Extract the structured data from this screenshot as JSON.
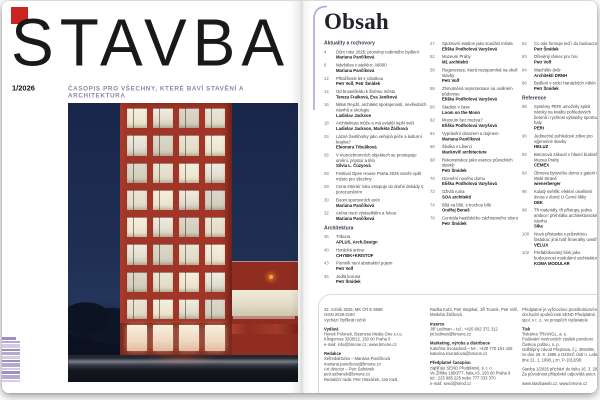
{
  "cover": {
    "masthead": "STAVBA",
    "issue": "1/2026",
    "tagline": "ČASOPIS PRO VŠECHNY, KTERÉ BAVÍ STAVĚNÍ A ARCHITEKTURA",
    "logo_color": "#c9241d",
    "photo_subject": "red high-rise office building at dusk with grid of lit windows, low red annex and road in foreground"
  },
  "contents": {
    "title": "Obsah",
    "columns": [
      {
        "items": [
          {
            "header": "Aktuality a rozhovory"
          },
          {
            "page": "4",
            "title": "Dům roku 2025: proměny rodinného bydlení",
            "author": "Mariana Pančíková"
          },
          {
            "page": "6",
            "title": "Návštěva v ateliéru: A8000",
            "author": "Mariana Pančíková"
          },
          {
            "page": "12",
            "title": "Přitažlivost let s robotkou",
            "author": "Petr Volf, Petr Šmídek"
          },
          {
            "page": "14",
            "title": "Od brownfieldu k živému městu",
            "author": "Tereza Fraiková, Eva Jeníková"
          },
          {
            "page": "16",
            "title": "Milan Rejchl, architekt spokojenosti, nevšedních návrhů a ekologie",
            "author": "Ladislav Jackson"
          },
          {
            "page": "18",
            "title": "Architektura může a má uvádět lepší svět",
            "author": "Ladislav Jackson, Markéta Žáčková"
          },
          {
            "page": "24",
            "title": "Lázně Šestihorky jako veřejná péče a kulturní krajina?",
            "author": "Eleonora Trbušková"
          },
          {
            "page": "26",
            "title": "V monochromních objektech se prostupuje umění, prostor a tělo",
            "author": "Silvia L. Čúzyová"
          },
          {
            "page": "28",
            "title": "Festival Open House Praha 2026 otevře opět město pro všechny",
            "author": ""
          },
          {
            "page": "29",
            "title": "Cena Interiér roku vstupuje do druhé dekády s porozuměním",
            "author": ""
          },
          {
            "page": "30",
            "title": "Boom sportovních arén",
            "author": "Mariana Pančíková"
          },
          {
            "page": "32",
            "title": "Aréna mezi výstavištěm a řekou",
            "author": "Mariana Pančíková"
          },
          {
            "header": "Architektura"
          },
          {
            "page": "36",
            "title": "Tribuna",
            "author": "APLUS, Arch.Design"
          },
          {
            "page": "40",
            "title": "Horácká aréna",
            "author": "CHYBIK+KRISTOF"
          },
          {
            "page": "43",
            "title": "Pomník není abstraktní pojem",
            "author": "Petr Volf"
          },
          {
            "page": "46",
            "title": "Jedlá koruna",
            "author": "Petr Šmídek"
          }
        ]
      },
      {
        "items": [
          {
            "page": "47",
            "title": "Sportovní stadion jako součást města",
            "author": "Eliška Podholová Varyšová"
          },
          {
            "page": "52",
            "title": "Muzeum Prahy",
            "author": "M1 architekti"
          },
          {
            "page": "56",
            "title": "Regenerace, která nezapomíná na okolí stavby",
            "author": "Petr Volf"
          },
          {
            "page": "58",
            "title": "Zhmotněná reprezentace na oválném půdorysu",
            "author": "Eliška Podholová Varyšová"
          },
          {
            "page": "60",
            "title": "Stadion v čase",
            "author": "Loom on the Moon"
          },
          {
            "page": "62",
            "title": "Muzeum bez muzea?",
            "author": "Eliška Podholová Varyšová"
          },
          {
            "page": "64",
            "title": "Vyprávění obrazem a dojmem",
            "author": "Mariana Pančíková"
          },
          {
            "page": "66",
            "title": "Školka v Liberci",
            "author": "Mackovič architecture"
          },
          {
            "page": "68",
            "title": "Rekonstrukce jako esence původních staveb",
            "author": "Petr Šmídek"
          },
          {
            "page": "70",
            "title": "Ocenění nového domu",
            "author": "Eliška Podholová Varyšová"
          },
          {
            "page": "72",
            "title": "Oživlá ruina",
            "author": "SOA architekti"
          },
          {
            "page": "74",
            "title": "Bílá na bílé, s trochou bílé",
            "author": "Ondřej Beneš"
          },
          {
            "page": "76",
            "title": "Centrála hasičského záchranného sboru",
            "author": "Petr Šmídek"
          }
        ]
      },
      {
        "items": [
          {
            "page": "82",
            "title": "Co nás formuje teď i do budoucna",
            "author": "Petr Šmídek"
          },
          {
            "page": "83",
            "title": "Dřevěný rámec pro hru",
            "author": "Petr Volf"
          },
          {
            "page": "84",
            "title": "Wachtlův dvůr",
            "author": "Architekti DRNH"
          },
          {
            "page": "86",
            "title": "Bydlení v srdci Hanáckých Athén",
            "author": "Petr Šmídek"
          },
          {
            "header": "Reference"
          },
          {
            "page": "88",
            "title": "Systémy PERI umožnily splnit nároky na kvalitu pohledových betonů i rychlost výstavby sportovní haly",
            "author": "PERI"
          },
          {
            "page": "90",
            "title": "Jedinečné pohledové zdivo pro výjimečné stavby",
            "author": "HELUZ"
          },
          {
            "page": "92",
            "title": "Betonová zákoutí v hlavní budově Muzea Prahy",
            "author": "CEMEX"
          },
          {
            "page": "94",
            "title": "Obnova bytového domu s galerií na Malé Straně",
            "author": "wienerberger"
          },
          {
            "page": "96",
            "title": "Kulatý světlík: efektní osvětlení dvora v domě U Černé lišky",
            "author": "DEK"
          },
          {
            "page": "98",
            "title": "Tři materiály, tři přístupy, jedna ambice: přehlídka architektonického návrhu",
            "author": "Sika"
          },
          {
            "page": "100",
            "title": "Nová přístavba s průsvitnou fasádou: jiná tvář Šmeralky uvnitř",
            "author": "VELUX"
          },
          {
            "page": "102",
            "title": "Prefabrikovaný blok jako budoucnost modulární architektury",
            "author": "KOMA MODULAR"
          }
        ]
      }
    ]
  },
  "imprint": {
    "columns": [
      {
        "groups": [
          {
            "header": "",
            "lines": [
              "32. ročník 2025, MK ČR E 6688",
              "ISSN 2029-2190",
              "Vychází čtyřikrát ročně"
            ]
          },
          {
            "header": "Vydává",
            "lines": [
              "Hynek Polonek, Business Media One s.r.o.",
              "Klingerova 3208/12, 150 00 Praha 5",
              "e-mail: info@bmone.cz, www.bmone.cz"
            ]
          },
          {
            "header": "Redakce",
            "lines": [
              "Šéfredaktorka – Mariana Pančíková",
              "mariana.pancikova@bmone.cz",
              "Art director – Petr Šafránek",
              "petr.safranek@bmone.cz",
              "Redakční rada: Petr Hlaváček, Jan Kasl,"
            ]
          }
        ]
      },
      {
        "groups": [
          {
            "header": "",
            "lines": [
              "Radka Kubí, Petr Stejskal, Jiří Tourek, Petr Volf,",
              "Markéta Žáčková"
            ]
          },
          {
            "header": "Inzerce",
            "lines": [
              "Jiří Ledman – tel.: +420 602 372 312",
              "jiri.ledman@bmone.cz"
            ]
          },
          {
            "header": "Marketing, výroba a distribuce",
            "lines": [
              "Kateřina Svoradová – tel.: +420 770 191 425",
              "katerina.svoradova@bmone.cz"
            ]
          },
          {
            "header": "Předplatné časopisu",
            "lines": [
              "zajišťuje SEND Předplatné, s. r. o.",
              "Ve Žlíbku 1800/77, hala A3, 193 00 Praha 9",
              "tel.: 225 985 225 nebo 777 333 370",
              "e-mail: send@send.cz"
            ]
          }
        ]
      },
      {
        "groups": [
          {
            "header": "",
            "lines": [
              "Předplatné je vyřizováno prostřednictvím",
              "obchodní společnosti SEND Předplatné,",
              "spol. s r. o., ve prospěch vydavatele"
            ]
          },
          {
            "header": "Tisk",
            "lines": [
              "Tiskárna TRIANGL, a. s.",
              "Podávání novinových zásilek povoleno",
              "Českou poštou, s. p.",
              "Odštěpný závod Přeprava, č.j. 3094/95,",
              "ze dne 29. 9. 1995 a OZSeČ Ústí n. Labem,",
              "dne 21. 1. 1998, j.zn. P-1012/98."
            ]
          },
          {
            "header": "",
            "lines": [
              "Stavba 1/2026 přichází do tisku 16. 3. 2026",
              "Za původnost příspěvků odpovídá autor."
            ]
          },
          {
            "header": "",
            "lines": [
              "www.stavbaweb.cz, www.bmone.cz"
            ]
          }
        ]
      }
    ]
  },
  "colors": {
    "accent_purple": "#b7a8d8",
    "tagline_purple": "#8d86a3",
    "cover_red": "#a13527",
    "logo_red": "#c9241d"
  }
}
